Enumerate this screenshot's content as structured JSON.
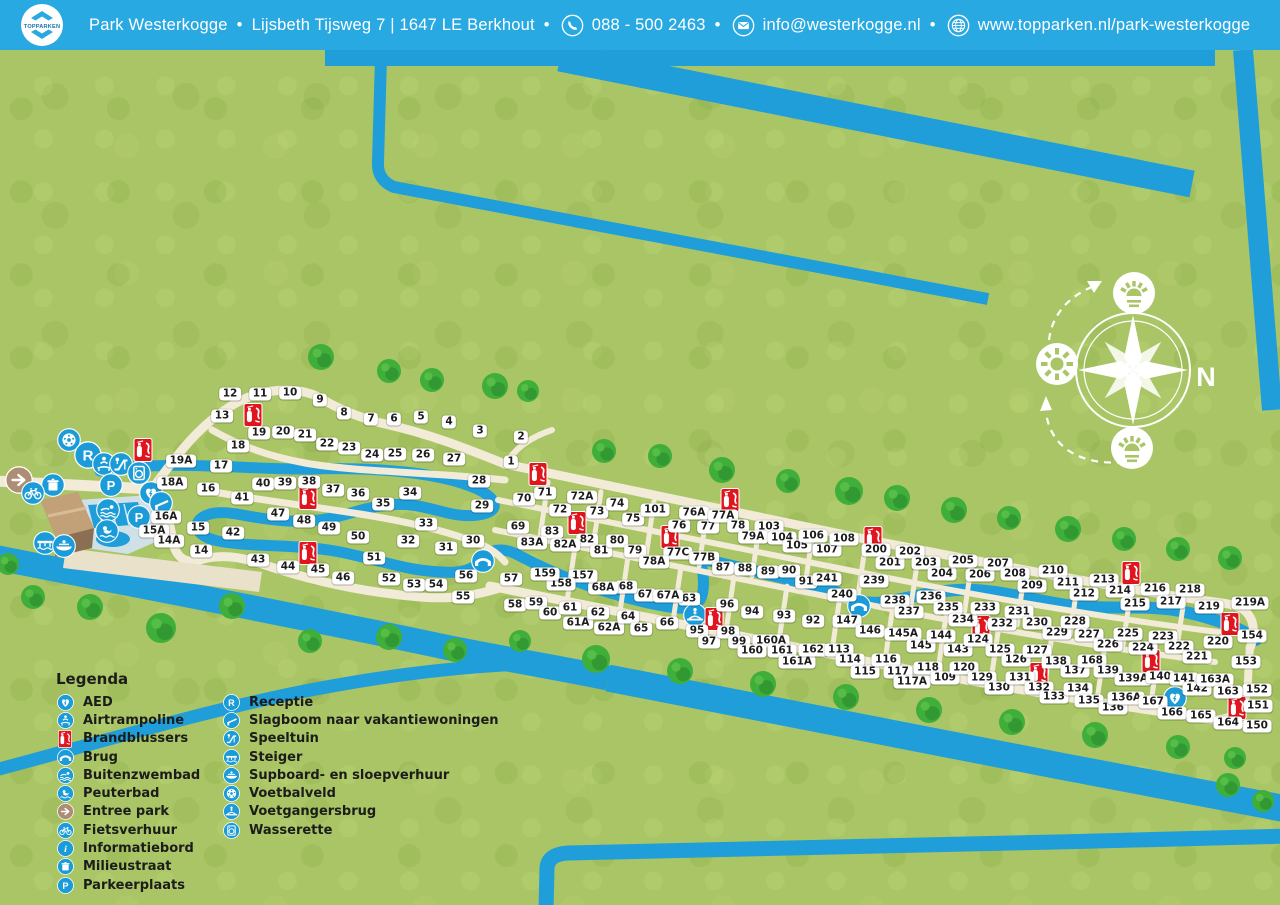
{
  "header": {
    "logo_text": "TOPPARKEN",
    "park_name": "Park Westerkogge",
    "address": "Lijsbeth Tijsweg 7 | 1647 LE Berkhout",
    "phone": "088 - 500 2463",
    "email": "info@westerkogge.nl",
    "website": "www.topparken.nl/park-westerkogge",
    "separator": "•"
  },
  "legend": {
    "title": "Legenda",
    "col1": [
      [
        "aed",
        "AED"
      ],
      [
        "airtrampoline",
        "Airtrampoline"
      ],
      [
        "brandblussers",
        "Brandblussers"
      ],
      [
        "brug",
        "Brug"
      ],
      [
        "buitenzwembad",
        "Buitenzwembad"
      ],
      [
        "peuterbad",
        "Peuterbad"
      ],
      [
        "entreepark",
        "Entree park"
      ],
      [
        "fietsverhuur",
        "Fietsverhuur"
      ],
      [
        "informatiebord",
        "Informatiebord"
      ],
      [
        "milieustraat",
        "Milieustraat"
      ],
      [
        "parkeerplaats",
        "Parkeerplaats"
      ]
    ],
    "col2": [
      [
        "receptie",
        "Receptie"
      ],
      [
        "slagboom",
        "Slagboom naar vakantiewoningen"
      ],
      [
        "speeltuin",
        "Speeltuin"
      ],
      [
        "steiger",
        "Steiger"
      ],
      [
        "supboard",
        "Supboard- en sloepverhuur"
      ],
      [
        "voetbalveld",
        "Voetbalveld"
      ],
      [
        "voetgangersbrug",
        "Voetgangersbrug"
      ],
      [
        "wasserette",
        "Wasserette"
      ]
    ]
  },
  "map": {
    "compass": {
      "n": "N",
      "w": "w",
      "z": "z",
      "o": "o"
    },
    "plots": [
      [
        "12",
        230,
        394
      ],
      [
        "11",
        260,
        394
      ],
      [
        "10",
        290,
        393
      ],
      [
        "9",
        320,
        400
      ],
      [
        "13",
        222,
        416
      ],
      [
        "8",
        344,
        413
      ],
      [
        "7",
        371,
        419
      ],
      [
        "6",
        394,
        419
      ],
      [
        "5",
        421,
        417
      ],
      [
        "4",
        449,
        422
      ],
      [
        "3",
        480,
        431
      ],
      [
        "2",
        521,
        437
      ],
      [
        "1",
        511,
        462
      ],
      [
        "19",
        259,
        433
      ],
      [
        "20",
        283,
        432
      ],
      [
        "21",
        305,
        435
      ],
      [
        "18",
        238,
        446
      ],
      [
        "22",
        327,
        444
      ],
      [
        "23",
        349,
        448
      ],
      [
        "24",
        372,
        455
      ],
      [
        "25",
        395,
        454
      ],
      [
        "26",
        423,
        455
      ],
      [
        "27",
        454,
        459
      ],
      [
        "17",
        221,
        466
      ],
      [
        "19A",
        181,
        461
      ],
      [
        "18A",
        172,
        483
      ],
      [
        "16",
        208,
        489
      ],
      [
        "28",
        479,
        481
      ],
      [
        "29",
        482,
        506
      ],
      [
        "40",
        263,
        484
      ],
      [
        "39",
        285,
        483
      ],
      [
        "38",
        309,
        482
      ],
      [
        "37",
        333,
        490
      ],
      [
        "36",
        358,
        494
      ],
      [
        "35",
        383,
        504
      ],
      [
        "34",
        410,
        493
      ],
      [
        "41",
        242,
        498
      ],
      [
        "16A",
        166,
        517
      ],
      [
        "15",
        198,
        528
      ],
      [
        "15A",
        154,
        531
      ],
      [
        "14A",
        169,
        541
      ],
      [
        "14",
        201,
        551
      ],
      [
        "42",
        233,
        533
      ],
      [
        "47",
        278,
        514
      ],
      [
        "48",
        304,
        521
      ],
      [
        "49",
        329,
        528
      ],
      [
        "50",
        358,
        537
      ],
      [
        "33",
        426,
        524
      ],
      [
        "32",
        408,
        541
      ],
      [
        "31",
        446,
        548
      ],
      [
        "30",
        473,
        541
      ],
      [
        "43",
        258,
        560
      ],
      [
        "44",
        288,
        567
      ],
      [
        "45",
        318,
        570
      ],
      [
        "46",
        343,
        578
      ],
      [
        "51",
        374,
        558
      ],
      [
        "52",
        389,
        579
      ],
      [
        "53",
        414,
        585
      ],
      [
        "54",
        436,
        585
      ],
      [
        "55",
        463,
        597
      ],
      [
        "56",
        466,
        576
      ],
      [
        "57",
        511,
        579
      ],
      [
        "58",
        515,
        605
      ],
      [
        "59",
        536,
        603
      ],
      [
        "60",
        550,
        613
      ],
      [
        "61",
        570,
        608
      ],
      [
        "61A",
        578,
        623
      ],
      [
        "62",
        598,
        613
      ],
      [
        "62A",
        609,
        628
      ],
      [
        "64",
        628,
        617
      ],
      [
        "65",
        641,
        629
      ],
      [
        "66",
        667,
        623
      ],
      [
        "63",
        689,
        599
      ],
      [
        "67",
        645,
        595
      ],
      [
        "67A",
        668,
        596
      ],
      [
        "68",
        626,
        587
      ],
      [
        "68A",
        603,
        588
      ],
      [
        "157",
        583,
        576
      ],
      [
        "158",
        561,
        584
      ],
      [
        "159",
        545,
        574
      ],
      [
        "70",
        524,
        499
      ],
      [
        "71",
        545,
        493
      ],
      [
        "72",
        560,
        510
      ],
      [
        "72A",
        582,
        497
      ],
      [
        "73",
        597,
        512
      ],
      [
        "74",
        617,
        504
      ],
      [
        "75",
        633,
        519
      ],
      [
        "101",
        655,
        510
      ],
      [
        "69",
        518,
        527
      ],
      [
        "83",
        552,
        532
      ],
      [
        "83A",
        532,
        543
      ],
      [
        "82",
        587,
        540
      ],
      [
        "82A",
        565,
        545
      ],
      [
        "81",
        601,
        551
      ],
      [
        "80",
        617,
        541
      ],
      [
        "79",
        635,
        551
      ],
      [
        "76",
        679,
        526
      ],
      [
        "76A",
        694,
        513
      ],
      [
        "77",
        708,
        527
      ],
      [
        "77A",
        723,
        516
      ],
      [
        "78",
        738,
        526
      ],
      [
        "103",
        769,
        527
      ],
      [
        "79A",
        753,
        537
      ],
      [
        "104",
        782,
        538
      ],
      [
        "105",
        797,
        546
      ],
      [
        "106",
        813,
        536
      ],
      [
        "107",
        827,
        550
      ],
      [
        "108",
        844,
        539
      ],
      [
        "77C",
        678,
        553
      ],
      [
        "77B",
        704,
        558
      ],
      [
        "78A",
        654,
        562
      ],
      [
        "87",
        723,
        568
      ],
      [
        "88",
        745,
        569
      ],
      [
        "89",
        768,
        572
      ],
      [
        "90",
        789,
        571
      ],
      [
        "91",
        806,
        582
      ],
      [
        "241",
        827,
        579
      ],
      [
        "240",
        842,
        595
      ],
      [
        "239",
        874,
        581
      ],
      [
        "200",
        876,
        550
      ],
      [
        "201",
        890,
        563
      ],
      [
        "202",
        910,
        552
      ],
      [
        "203",
        926,
        563
      ],
      [
        "204",
        942,
        574
      ],
      [
        "205",
        963,
        561
      ],
      [
        "206",
        980,
        575
      ],
      [
        "207",
        998,
        564
      ],
      [
        "208",
        1015,
        574
      ],
      [
        "209",
        1032,
        586
      ],
      [
        "210",
        1053,
        571
      ],
      [
        "211",
        1068,
        583
      ],
      [
        "212",
        1084,
        594
      ],
      [
        "213",
        1104,
        580
      ],
      [
        "214",
        1120,
        591
      ],
      [
        "215",
        1135,
        604
      ],
      [
        "216",
        1155,
        589
      ],
      [
        "217",
        1171,
        602
      ],
      [
        "218",
        1190,
        590
      ],
      [
        "219",
        1209,
        607
      ],
      [
        "219A",
        1250,
        603
      ],
      [
        "238",
        895,
        601
      ],
      [
        "237",
        909,
        612
      ],
      [
        "236",
        931,
        597
      ],
      [
        "235",
        948,
        608
      ],
      [
        "234",
        963,
        620
      ],
      [
        "233",
        985,
        608
      ],
      [
        "232",
        1002,
        624
      ],
      [
        "231",
        1019,
        612
      ],
      [
        "230",
        1037,
        623
      ],
      [
        "229",
        1057,
        633
      ],
      [
        "228",
        1075,
        622
      ],
      [
        "227",
        1089,
        635
      ],
      [
        "226",
        1108,
        645
      ],
      [
        "225",
        1128,
        634
      ],
      [
        "224",
        1143,
        648
      ],
      [
        "223",
        1163,
        637
      ],
      [
        "222",
        1179,
        647
      ],
      [
        "221",
        1197,
        657
      ],
      [
        "220",
        1218,
        642
      ],
      [
        "154",
        1252,
        636
      ],
      [
        "153",
        1246,
        662
      ],
      [
        "152",
        1257,
        690
      ],
      [
        "151",
        1258,
        706
      ],
      [
        "150",
        1257,
        726
      ],
      [
        "92",
        813,
        621
      ],
      [
        "93",
        784,
        616
      ],
      [
        "94",
        752,
        612
      ],
      [
        "95",
        697,
        631
      ],
      [
        "96",
        727,
        605
      ],
      [
        "97",
        709,
        642
      ],
      [
        "98",
        728,
        632
      ],
      [
        "99",
        739,
        642
      ],
      [
        "160A",
        771,
        641
      ],
      [
        "160",
        752,
        651
      ],
      [
        "161",
        782,
        651
      ],
      [
        "161A",
        797,
        662
      ],
      [
        "162",
        813,
        650
      ],
      [
        "147",
        847,
        621
      ],
      [
        "146",
        870,
        631
      ],
      [
        "145A",
        903,
        634
      ],
      [
        "145",
        921,
        646
      ],
      [
        "144",
        941,
        636
      ],
      [
        "143",
        958,
        650
      ],
      [
        "124",
        978,
        640
      ],
      [
        "125",
        1000,
        650
      ],
      [
        "126",
        1016,
        660
      ],
      [
        "127",
        1037,
        651
      ],
      [
        "138",
        1056,
        662
      ],
      [
        "137",
        1075,
        671
      ],
      [
        "168",
        1092,
        661
      ],
      [
        "139",
        1108,
        671
      ],
      [
        "139A",
        1133,
        679
      ],
      [
        "140",
        1160,
        677
      ],
      [
        "141",
        1184,
        679
      ],
      [
        "142",
        1197,
        689
      ],
      [
        "163A",
        1215,
        680
      ],
      [
        "163",
        1228,
        692
      ],
      [
        "113",
        839,
        650
      ],
      [
        "114",
        850,
        660
      ],
      [
        "115",
        865,
        672
      ],
      [
        "116",
        886,
        660
      ],
      [
        "117",
        898,
        672
      ],
      [
        "117A",
        912,
        682
      ],
      [
        "118",
        928,
        668
      ],
      [
        "109",
        945,
        678
      ],
      [
        "120",
        964,
        668
      ],
      [
        "129",
        982,
        678
      ],
      [
        "130",
        999,
        688
      ],
      [
        "131",
        1020,
        678
      ],
      [
        "132",
        1039,
        688
      ],
      [
        "133",
        1054,
        697
      ],
      [
        "134",
        1078,
        689
      ],
      [
        "135",
        1089,
        701
      ],
      [
        "136",
        1113,
        708
      ],
      [
        "136A",
        1126,
        698
      ],
      [
        "167",
        1153,
        702
      ],
      [
        "166",
        1172,
        713
      ],
      [
        "165",
        1201,
        716
      ],
      [
        "164",
        1228,
        723
      ]
    ],
    "icons": [
      [
        "voetbalveld",
        69,
        440
      ],
      [
        "receptie",
        88,
        455
      ],
      [
        "airtrampoline",
        104,
        464
      ],
      [
        "speeltuin",
        121,
        464
      ],
      [
        "wasserette",
        139,
        473
      ],
      [
        "milieustraat",
        53,
        485
      ],
      [
        "entreepark",
        19,
        480
      ],
      [
        "fietsverhuur",
        33,
        493
      ],
      [
        "parkeerplaats",
        111,
        485
      ],
      [
        "parkeerplaats",
        139,
        517
      ],
      [
        "aed",
        151,
        493
      ],
      [
        "aed",
        1175,
        698
      ],
      [
        "buitenzwembad",
        108,
        510
      ],
      [
        "peuterbad",
        107,
        531
      ],
      [
        "steiger",
        45,
        543
      ],
      [
        "supboard",
        64,
        546
      ],
      [
        "slagboom",
        161,
        503
      ],
      [
        "brug",
        483,
        561
      ],
      [
        "brug",
        859,
        606
      ],
      [
        "voetgangersbrug",
        695,
        615
      ],
      [
        "brandblussers",
        143,
        450
      ],
      [
        "brandblussers",
        253,
        415
      ],
      [
        "brandblussers",
        308,
        498
      ],
      [
        "brandblussers",
        308,
        553
      ],
      [
        "brandblussers",
        538,
        474
      ],
      [
        "brandblussers",
        577,
        523
      ],
      [
        "brandblussers",
        730,
        500
      ],
      [
        "brandblussers",
        670,
        537
      ],
      [
        "brandblussers",
        714,
        619
      ],
      [
        "brandblussers",
        873,
        538
      ],
      [
        "brandblussers",
        981,
        627
      ],
      [
        "brandblussers",
        1131,
        573
      ],
      [
        "brandblussers",
        1230,
        624
      ],
      [
        "brandblussers",
        1039,
        674
      ],
      [
        "brandblussers",
        1151,
        661
      ],
      [
        "brandblussers",
        1237,
        708
      ]
    ],
    "trees": [
      [
        321,
        357,
        13
      ],
      [
        389,
        371,
        12
      ],
      [
        432,
        380,
        12
      ],
      [
        495,
        386,
        13
      ],
      [
        528,
        391,
        11
      ],
      [
        604,
        451,
        12
      ],
      [
        660,
        456,
        12
      ],
      [
        722,
        470,
        13
      ],
      [
        788,
        481,
        12
      ],
      [
        849,
        491,
        14
      ],
      [
        897,
        498,
        13
      ],
      [
        954,
        510,
        13
      ],
      [
        1009,
        518,
        12
      ],
      [
        1068,
        529,
        13
      ],
      [
        1124,
        539,
        12
      ],
      [
        1178,
        549,
        12
      ],
      [
        1230,
        558,
        12
      ],
      [
        8,
        564,
        11
      ],
      [
        33,
        597,
        12
      ],
      [
        90,
        607,
        13
      ],
      [
        161,
        628,
        15
      ],
      [
        232,
        606,
        13
      ],
      [
        310,
        641,
        12
      ],
      [
        389,
        637,
        13
      ],
      [
        455,
        650,
        12
      ],
      [
        520,
        641,
        11
      ],
      [
        596,
        659,
        14
      ],
      [
        680,
        671,
        13
      ],
      [
        763,
        684,
        13
      ],
      [
        846,
        697,
        13
      ],
      [
        929,
        710,
        13
      ],
      [
        1012,
        722,
        13
      ],
      [
        1095,
        735,
        13
      ],
      [
        1178,
        747,
        12
      ],
      [
        1235,
        758,
        11
      ],
      [
        1228,
        785,
        12
      ],
      [
        1263,
        801,
        11
      ]
    ]
  },
  "colors": {
    "header_blue": "#29a9e1",
    "water_blue": "#1f9ed9",
    "grass_green": "#aac565",
    "road_cream": "#f1ebd8",
    "icon_blue": "#1b9cd8",
    "brand_red": "#e0151e",
    "entree_brown": "#ad8d74",
    "tree_green": "#3fae3a"
  }
}
